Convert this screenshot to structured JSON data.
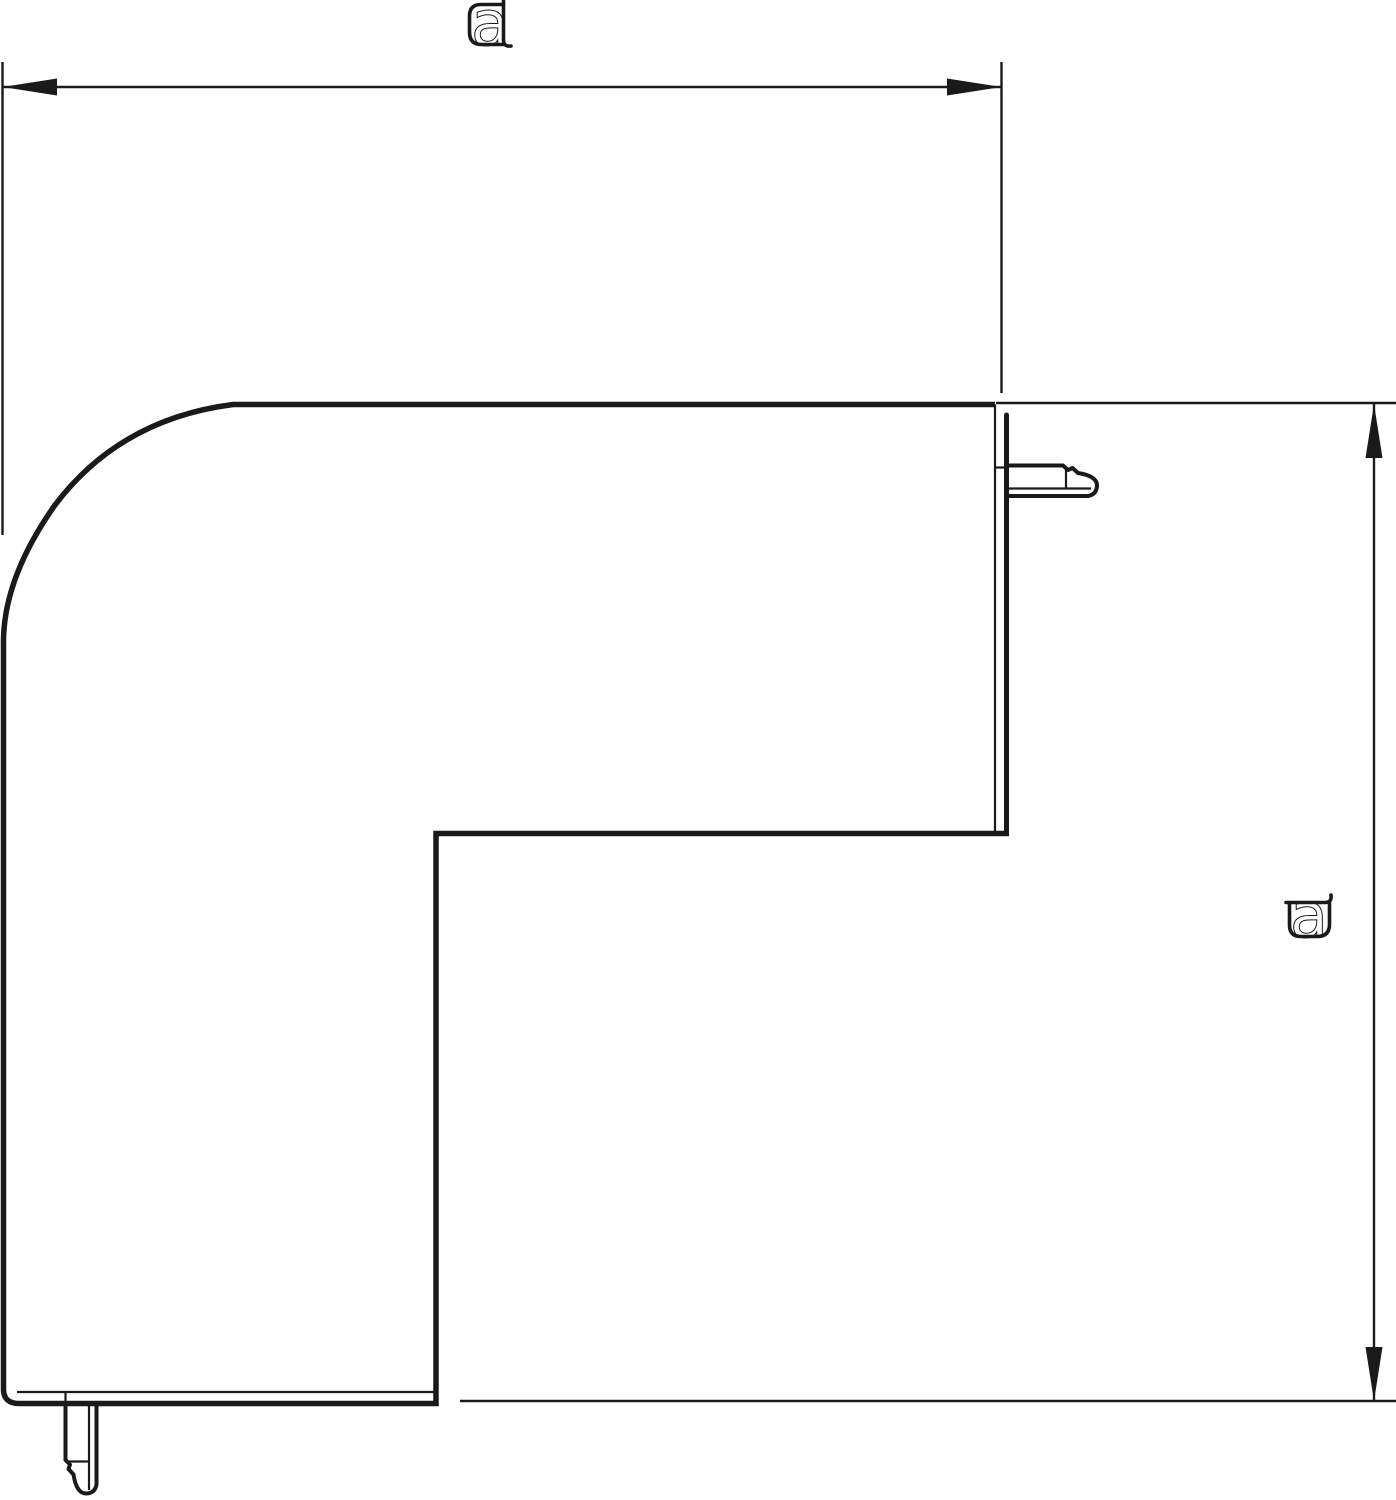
{
  "drawing": {
    "background": "#ffffff",
    "line_color": "#1a1a1a",
    "dimensions": {
      "width": {
        "label": "a",
        "position": "top",
        "orientation": "horizontal"
      },
      "height": {
        "label": "a",
        "position": "right",
        "orientation": "vertical"
      }
    }
  }
}
